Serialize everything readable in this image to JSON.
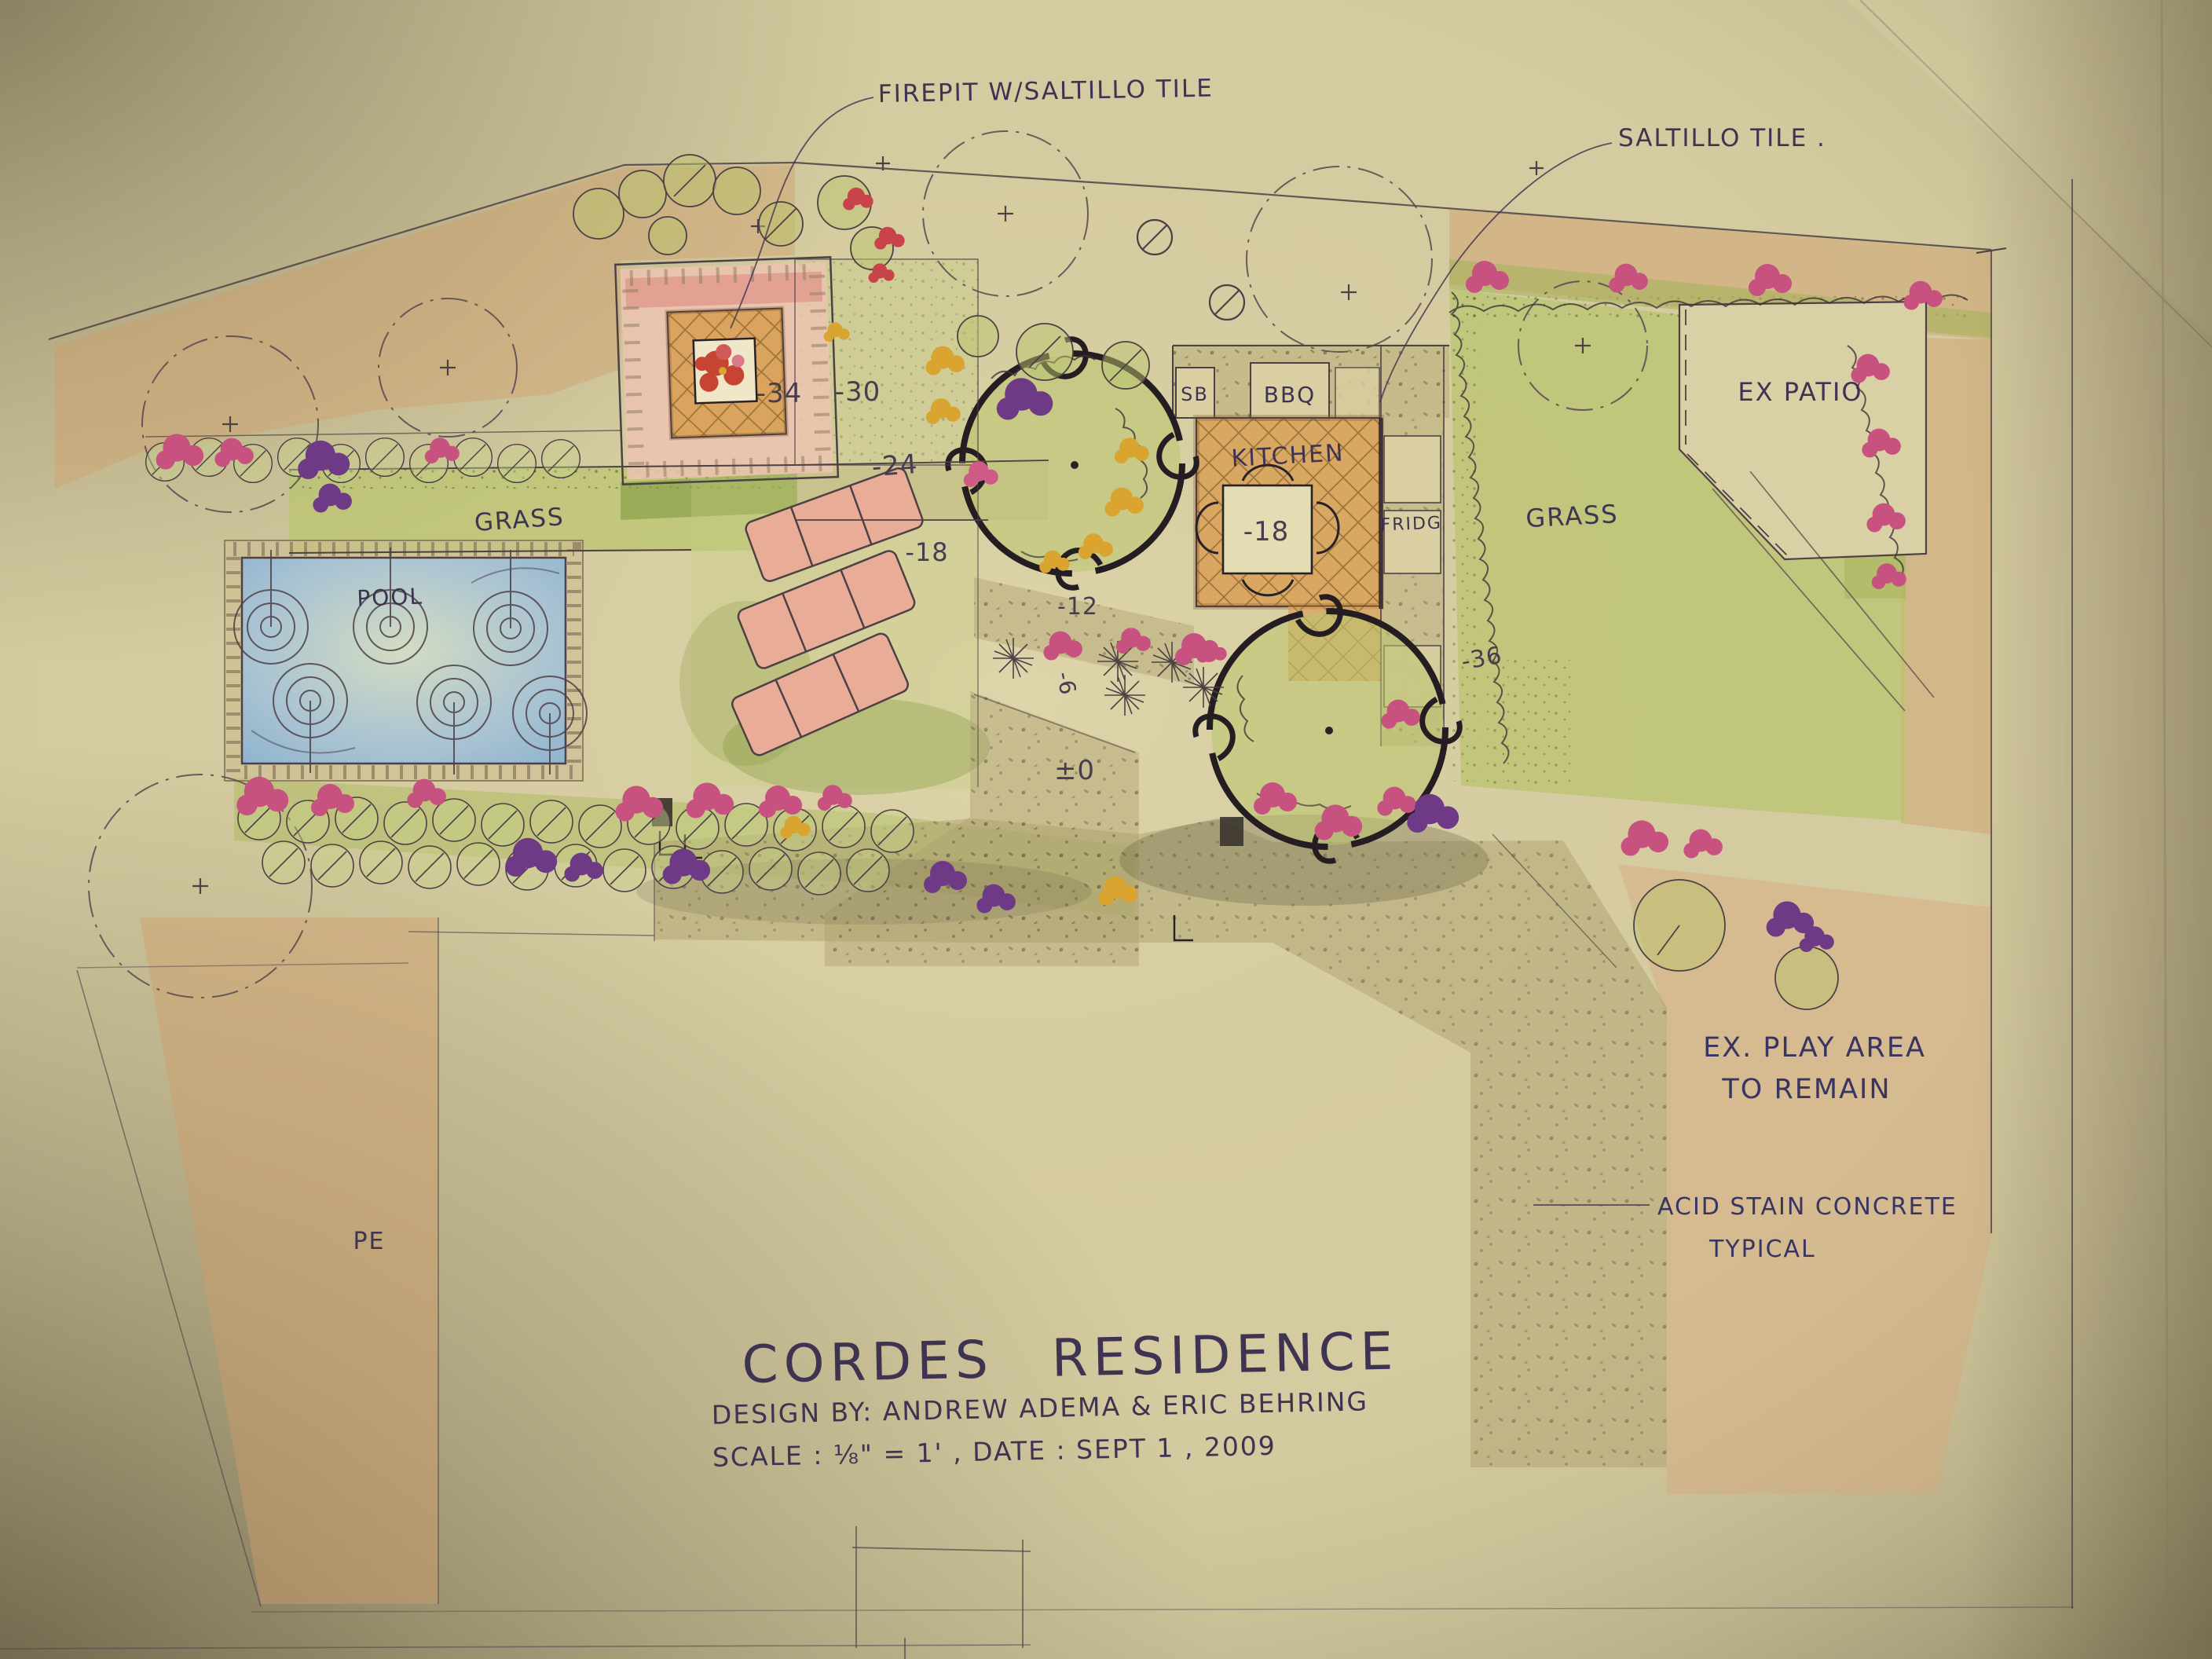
{
  "sheet": {
    "title": "CORDES RESIDENCE",
    "byline": "DESIGN BY: ANDREW ADEMA & ERIC BEHRING",
    "scale_date": "SCALE : ⅛\" = 1' , DATE : SEPT 1 , 2009"
  },
  "annotations": {
    "firepit_note": "FIREPIT W/SALTILLO TILE",
    "saltillo_note": "SALTILLO TILE .",
    "play_area_1": "EX. PLAY AREA",
    "play_area_2": "TO REMAIN",
    "acid_stain_1": "ACID STAIN CONCRETE",
    "acid_stain_2": "TYPICAL",
    "pe_note": "PE"
  },
  "labels": {
    "pool": "POOL",
    "grass_left": "GRASS",
    "grass_right": "GRASS",
    "kitchen": "KITCHEN",
    "bbq": "BBQ",
    "sb": "SB",
    "fridge": "FRIDG",
    "ex_patio": "EX PATIO"
  },
  "elevations": {
    "firepit": "-34",
    "terrace": "-30",
    "upper_walk": "-24",
    "lounge": "-18",
    "kitchen_table": "-18",
    "planter_walk": "-12",
    "mid_step": "-6",
    "datum": "±0",
    "right_grass": "-36"
  },
  "palette": {
    "paper": "#d5cba0",
    "tan_wash": "#cf9e6a",
    "grass_green": "#b9c46d",
    "pool_blue": "#8fb3cf",
    "tile_pink": "#ecc3b1",
    "saltillo_tan": "#d8a057",
    "flower_magenta": "#c7527f",
    "flower_purple": "#6e3a86",
    "accent_gold": "#d9a42f",
    "fire_red": "#c84432",
    "ink": "#282127",
    "pen": "#4d4146",
    "hand_ink": "#3f3352",
    "blue_ink": "#3a3560"
  }
}
